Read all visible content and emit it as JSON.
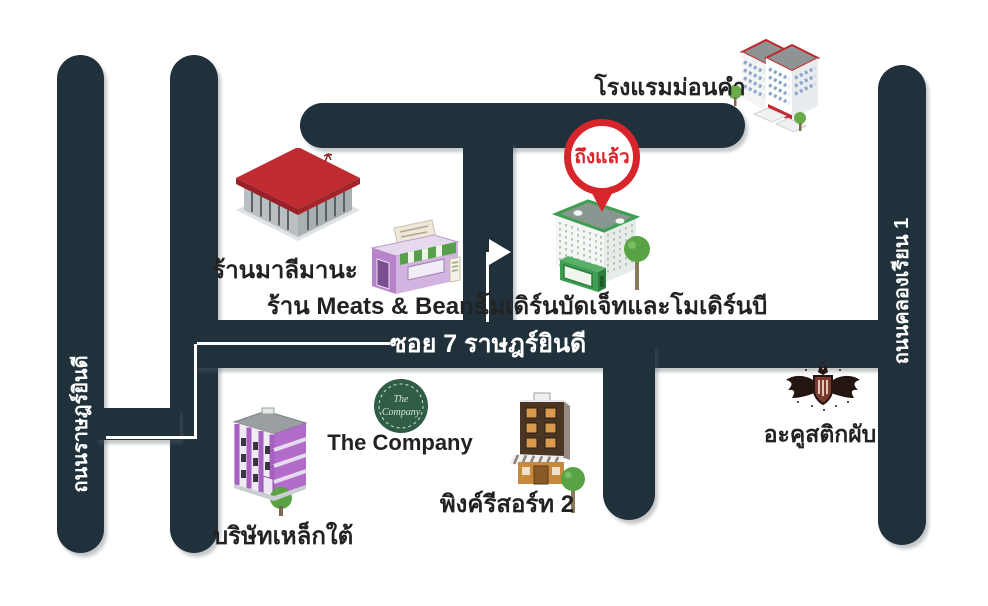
{
  "pin": {
    "label": "ถึงแล้ว"
  },
  "roads": {
    "left_vertical": {
      "label": "ถนนราษฎร์ยินดี"
    },
    "soi_7": {
      "label": "ซอย 7 ราษฎร์ยินดี"
    },
    "right_vertical": {
      "label": "ถนนคลองเรียน 1"
    }
  },
  "places": {
    "hotel": {
      "label": "โรงแรมม่อนคำ"
    },
    "malimana_shop": {
      "label": "ร้านมาลีมานะ"
    },
    "meats_and_beans": {
      "label": "ร้าน Meats & Beans"
    },
    "destination": {
      "label": "โมเดิร์นบัดเจ็ทและโมเดิร์นบี"
    },
    "the_company": {
      "label": "The Company",
      "logo_line1": "The",
      "logo_line2": "Company"
    },
    "steel_company": {
      "label": "บริษัทเหล็กใต้"
    },
    "pink_resort": {
      "label": "พิงค์รีสอร์ท 2"
    },
    "acoustic_pub": {
      "label": "อะคูสติกผับ"
    }
  },
  "colors": {
    "road": "#20313c",
    "road_text": "#ffffff",
    "label_text": "#222222",
    "pin_red": "#d8252c",
    "destination_green": "#3f9e52"
  }
}
